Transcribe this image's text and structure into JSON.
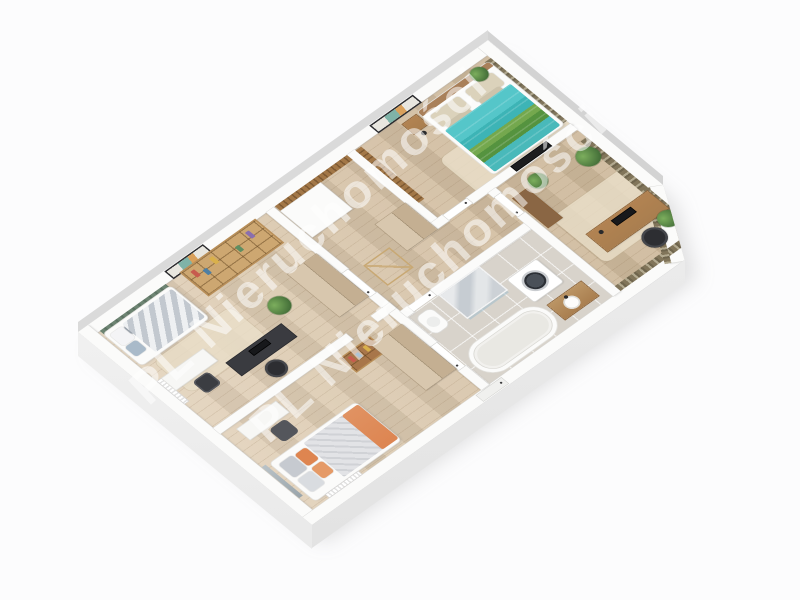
{
  "watermark": {
    "text": "PL Nieruchomości",
    "color": "#ffffff",
    "opacity": 0.55,
    "rotation_deg": -43
  },
  "palette": {
    "background": "#fcfcfd",
    "wall": "#fbfbfa",
    "wall_line": "#d9d9d7",
    "floor_wood": "#dcc8ab",
    "floor_tile": "#d8d3cb",
    "rug": "#eadfc9",
    "green_panel": "#66806c",
    "teal_duvet": "#45bcc0",
    "green_duvet": "#5f9a41",
    "curtain": "#81755a",
    "curtain_light": "#b2a98f",
    "wood_light": "#cda771",
    "wood_mid": "#a97e4f",
    "wood_dark": "#8a6644",
    "cabinet_beige": "#d8c7ae",
    "cabinet_beige_dark": "#c4af92",
    "orange_accent": "#dd8551",
    "dark_furniture": "#2d2e32",
    "marble": "#ccd1d6"
  },
  "scene": {
    "description": "3D isometric render of a furnished apartment floor plan on a white background",
    "rooms": [
      {
        "id": "kids-bedroom",
        "furniture": [
          "single-bed",
          "striped-duvet",
          "pillows",
          "green-wall-panel",
          "wall-art",
          "bookshelf",
          "wardrobe",
          "white-desk",
          "dark-desk",
          "office-chairs",
          "plant",
          "rug",
          "radiator"
        ]
      },
      {
        "id": "teen-bedroom",
        "furniture": [
          "bed",
          "orange-accent-pillows",
          "desk",
          "chair",
          "small-bookshelf",
          "wardrobe",
          "radiator",
          "balcony-glass"
        ]
      },
      {
        "id": "master-bedroom",
        "furniture": [
          "double-bed",
          "teal-green-duvet",
          "pillows",
          "nightstand",
          "floor-lamp",
          "wall-art",
          "wood-slat-panel",
          "window-curtains",
          "rug",
          "tv-panel",
          "plant"
        ]
      },
      {
        "id": "home-office",
        "furniture": [
          "wooden-desk",
          "monitor",
          "office-chair",
          "sideboard",
          "plants",
          "window-curtains",
          "rug"
        ]
      },
      {
        "id": "bathroom",
        "furniture": [
          "freestanding-bathtub",
          "washing-machine",
          "marble-shower",
          "toilet",
          "vanity-basin"
        ]
      },
      {
        "id": "hallway",
        "furniture": [
          "closet",
          "beige-cabinet",
          "wood-slat-wall",
          "interior-doors",
          "entry-door"
        ]
      }
    ]
  }
}
